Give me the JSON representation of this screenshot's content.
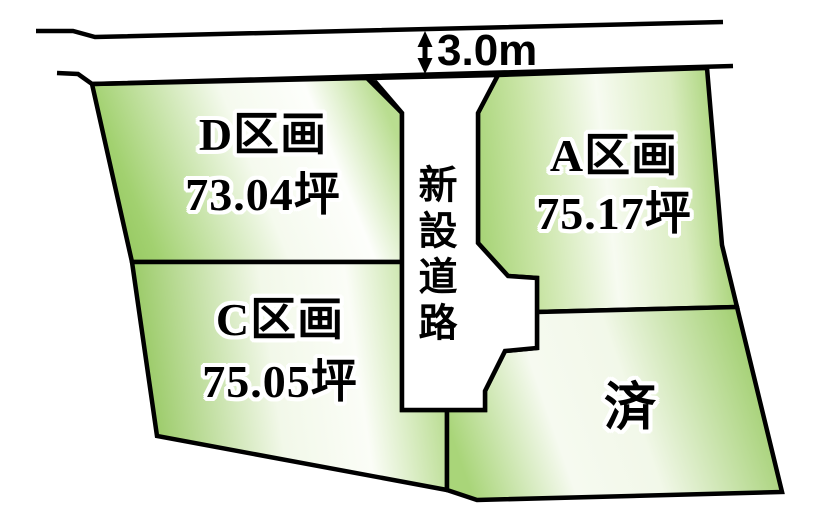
{
  "diagram": {
    "type": "land-plot-map",
    "road": {
      "width_label": "3.0m",
      "new_road_label": "新設道路"
    },
    "plots": [
      {
        "id": "D",
        "name": "D区画",
        "area": "73.04坪",
        "status": "available"
      },
      {
        "id": "A",
        "name": "A区画",
        "area": "75.17坪",
        "status": "available"
      },
      {
        "id": "C",
        "name": "C区画",
        "area": "75.05坪",
        "status": "available"
      },
      {
        "id": "sold",
        "name": "済",
        "status": "sold"
      }
    ],
    "colors": {
      "plot_green_dark": "#97c961",
      "plot_green_mid": "#b9dd90",
      "plot_highlight": "#f7fbf1",
      "outline": "#000000",
      "road_fill": "#ffffff",
      "text": "#000000",
      "text_halo": "#ffffff"
    }
  }
}
